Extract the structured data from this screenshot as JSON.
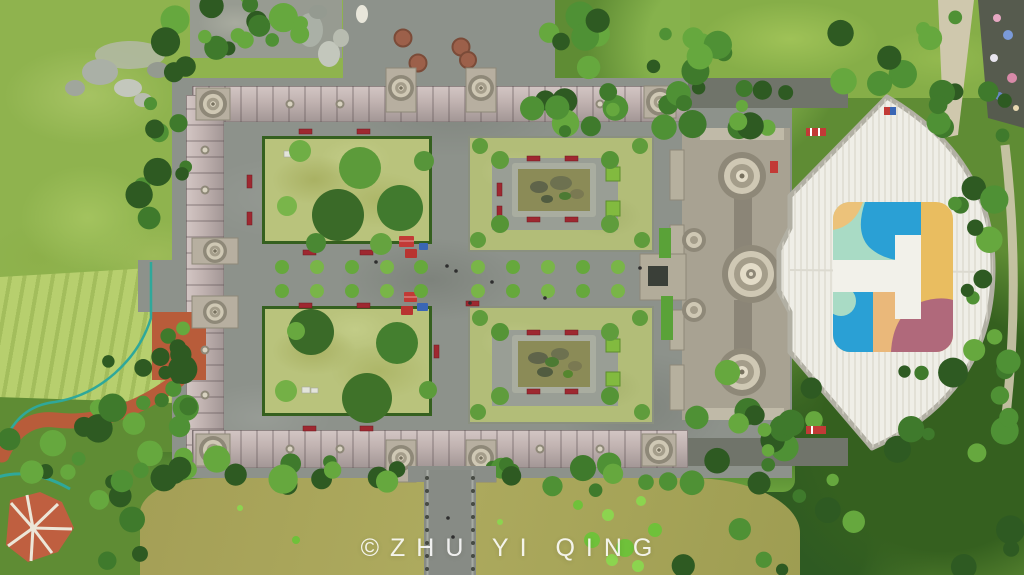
{
  "meta": {
    "type": "aerial-drone-photograph",
    "description": "Top-down aerial view of a symmetric temple-garden complex: four walled courtyard gardens (two tree lawns, two with central rock pools), colonnade walls with ornate tiered stone towers and gates, a grand stepped temple with a huge white fan-shaped roof painted with a colorful logo, surrounded by woodland, terraced fields, a winding red footpath, a red star-paved plaza and an olive-green pond crossed by a stone bridge."
  },
  "watermark": {
    "text": "©ZHU YI QING"
  },
  "palette": {
    "forest_green": "#3f7a2c",
    "lawn_green": "#b9c37c",
    "meadow_green": "#8fb34e",
    "plaza_grey": "#8d928b",
    "wall_roof_pink": "#c5b7b5",
    "tower_stone": "#cfc8b4",
    "temple_stone": "#a8a292",
    "roof_white": "#eeede6",
    "pond_olive": "#a49f56",
    "pool_water": "#8b8b57",
    "path_red": "#b85c3a",
    "bench_red": "#9e2830",
    "tent_red": "#c23a36",
    "tent_blue": "#3a66b5",
    "fence_teal": "#2fa89a"
  },
  "roof_logo_colors": {
    "blue": "#2aa0d5",
    "mint": "#a9dbc5",
    "yellow": "#e9bd60",
    "orange": "#ecc27a",
    "maroon": "#b0697b",
    "white": "#f2f1ea"
  }
}
